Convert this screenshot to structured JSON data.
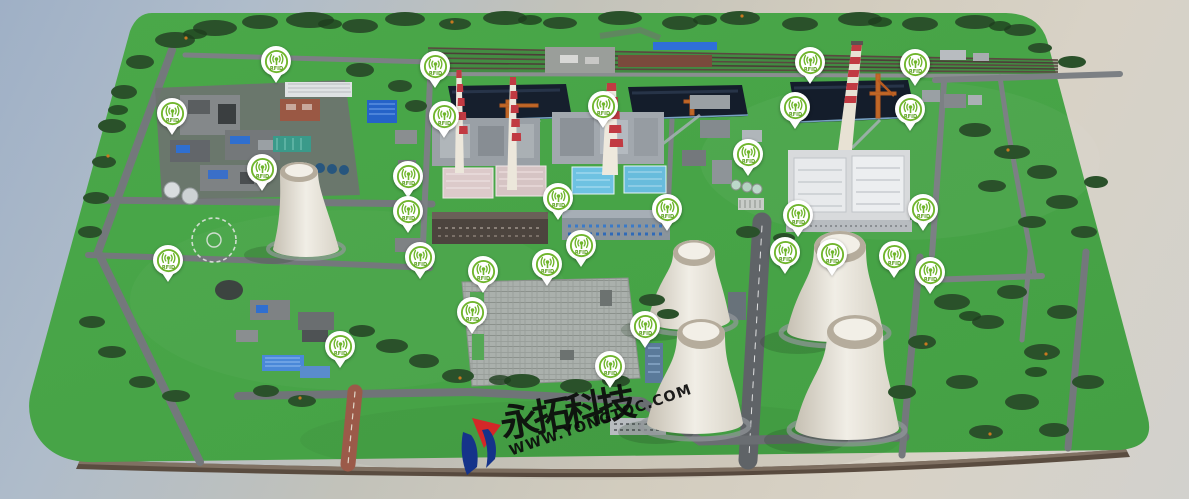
{
  "scene": {
    "name": "power-plant-3d-campus-map",
    "description": "3D aerial model of a coal power plant campus with RFID location markers"
  },
  "watermark": {
    "company": "永拓科技",
    "url": "WWW.YONGTOC.COM"
  },
  "marker": {
    "label": "RFID",
    "icon": "rfid-signal-icon",
    "color": "#6fb52c"
  },
  "markers": [
    {
      "x": 276,
      "y": 62
    },
    {
      "x": 172,
      "y": 114
    },
    {
      "x": 262,
      "y": 170
    },
    {
      "x": 435,
      "y": 67
    },
    {
      "x": 444,
      "y": 117
    },
    {
      "x": 603,
      "y": 107
    },
    {
      "x": 748,
      "y": 155
    },
    {
      "x": 795,
      "y": 108
    },
    {
      "x": 810,
      "y": 63
    },
    {
      "x": 915,
      "y": 65
    },
    {
      "x": 910,
      "y": 110
    },
    {
      "x": 923,
      "y": 210
    },
    {
      "x": 798,
      "y": 216
    },
    {
      "x": 667,
      "y": 210
    },
    {
      "x": 558,
      "y": 199
    },
    {
      "x": 408,
      "y": 177
    },
    {
      "x": 408,
      "y": 212
    },
    {
      "x": 581,
      "y": 246
    },
    {
      "x": 420,
      "y": 258
    },
    {
      "x": 483,
      "y": 272
    },
    {
      "x": 547,
      "y": 265
    },
    {
      "x": 472,
      "y": 313
    },
    {
      "x": 645,
      "y": 327
    },
    {
      "x": 610,
      "y": 367
    },
    {
      "x": 168,
      "y": 261
    },
    {
      "x": 340,
      "y": 347
    },
    {
      "x": 785,
      "y": 253
    },
    {
      "x": 832,
      "y": 255
    },
    {
      "x": 894,
      "y": 257
    },
    {
      "x": 930,
      "y": 273
    }
  ],
  "palette": {
    "grass": "#47a447",
    "sky_top": "#9fb0c6",
    "sky_bottom": "#d8d2c6",
    "road": "#74787c",
    "marker_green": "#6fb52c",
    "stack_red": "#c13a42",
    "coal": "#161f2d",
    "roof_blue": "#6ec2e2",
    "roof_pink": "#dccaca",
    "logo_red": "#d42828",
    "logo_blue": "#15338a",
    "tower_white": "#efece4"
  }
}
